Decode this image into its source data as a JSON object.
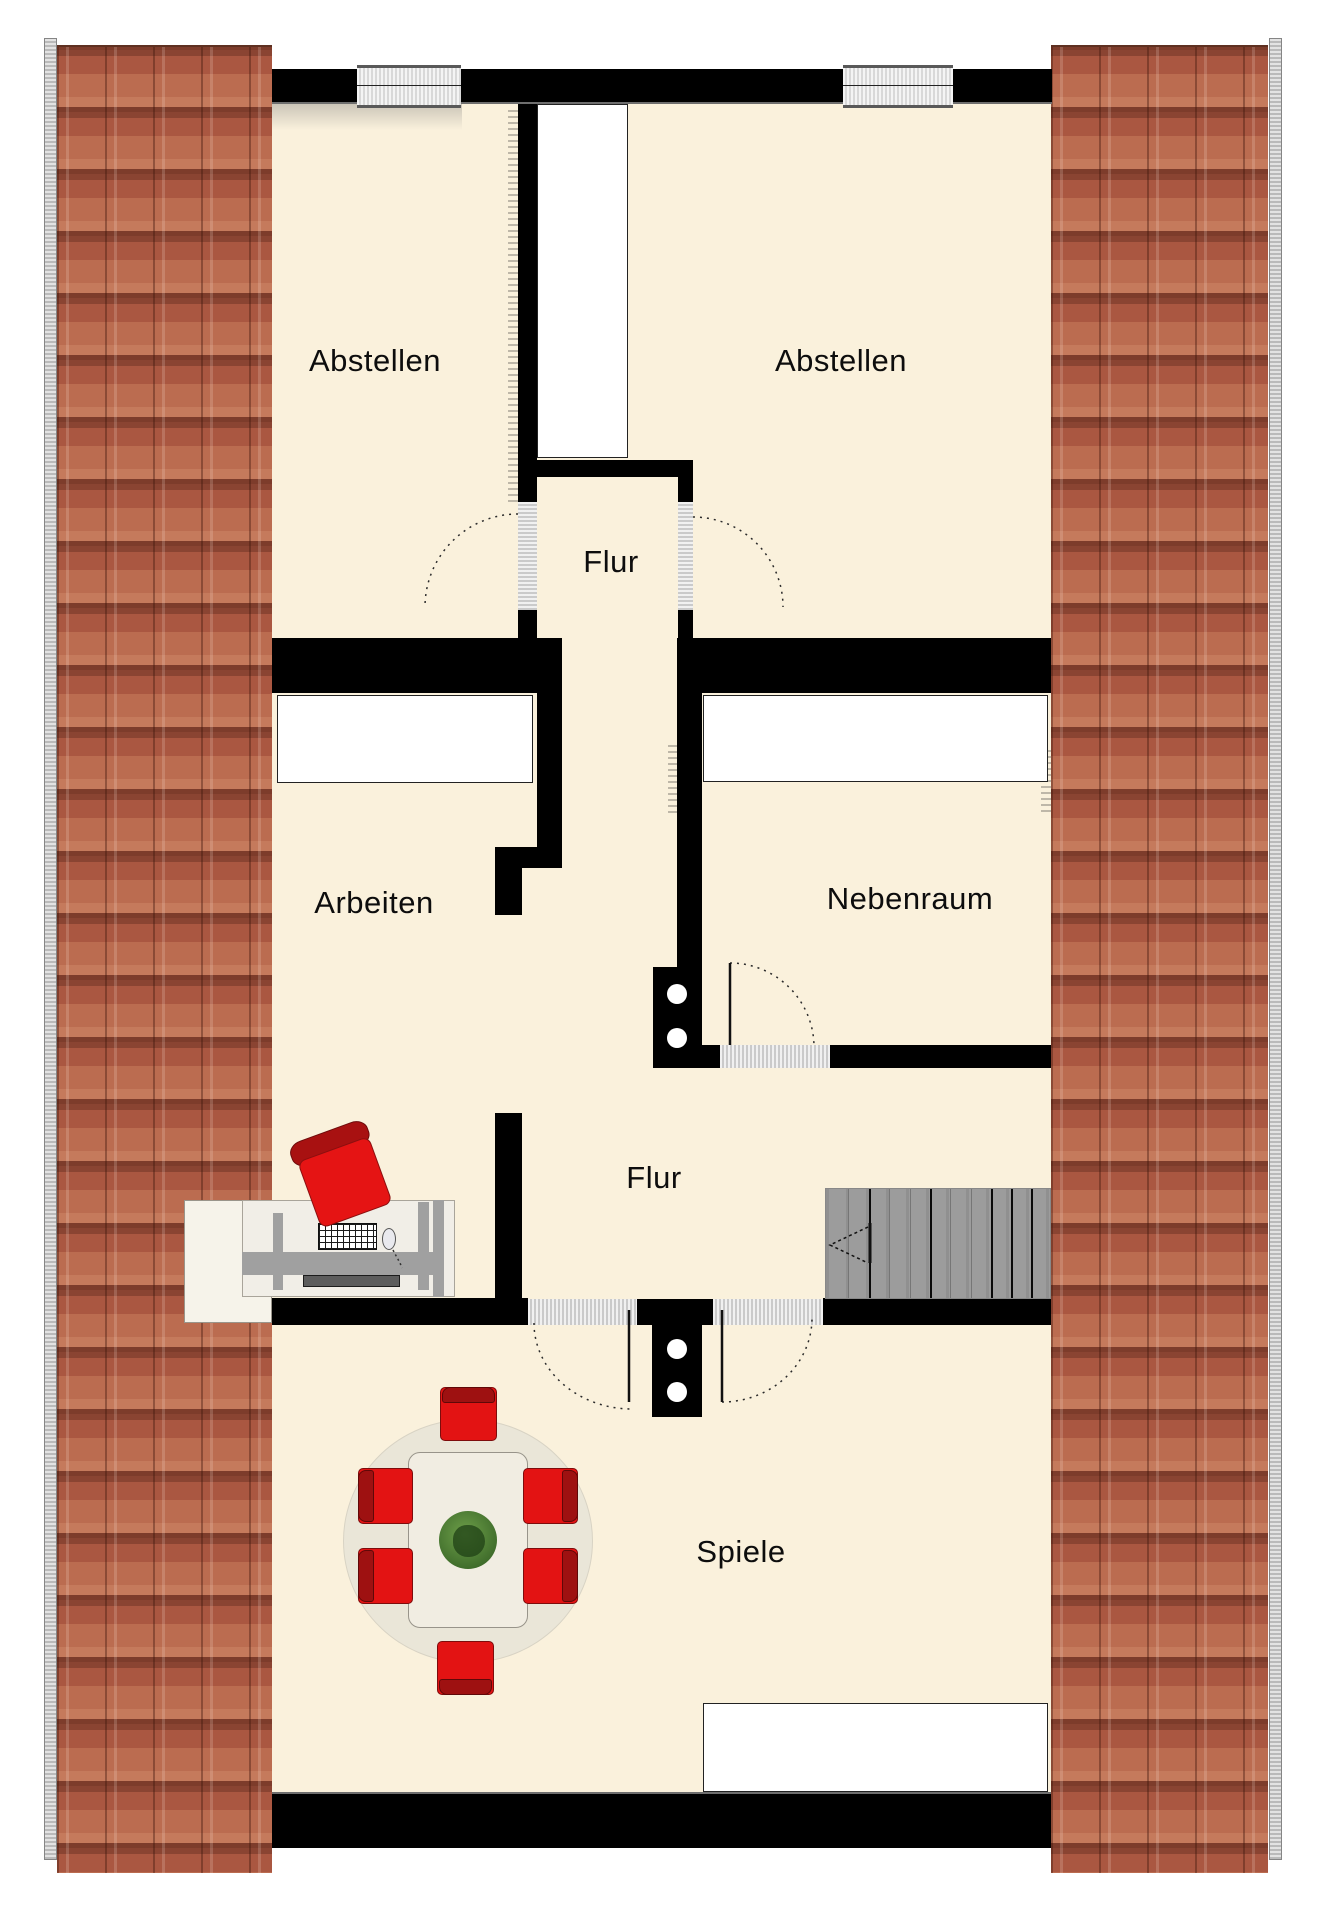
{
  "floorplan": {
    "rooms": [
      {
        "id": "abstellen-left",
        "label": "Abstellen"
      },
      {
        "id": "abstellen-right",
        "label": "Abstellen"
      },
      {
        "id": "flur-top",
        "label": "Flur"
      },
      {
        "id": "arbeiten",
        "label": "Arbeiten"
      },
      {
        "id": "nebenraum",
        "label": "Nebenraum"
      },
      {
        "id": "flur-lower",
        "label": "Flur"
      },
      {
        "id": "spiele",
        "label": "Spiele"
      }
    ],
    "colors": {
      "floor": "#FAF1DC",
      "wall": "#000000",
      "roof_tile": "#AC5840",
      "roof_edge": "#C6C6C6",
      "chair_red": "#E31313",
      "chair_back_red": "#9E1111",
      "stairs_gray": "#9C9C9C",
      "window_gray": "#E4E4E4",
      "threshold_gray": "#DBDBDB",
      "plant_green": "#2E5A20"
    }
  }
}
